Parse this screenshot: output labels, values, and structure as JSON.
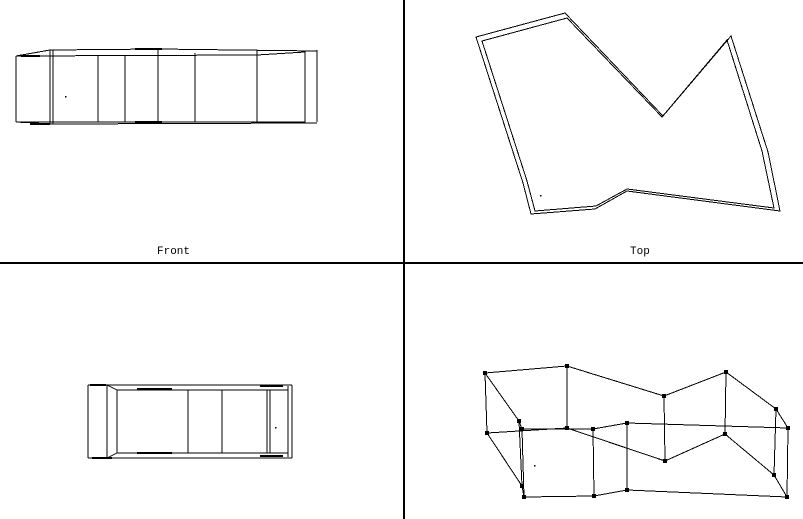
{
  "window": {
    "width": 803,
    "height": 519,
    "background": "#ffffff",
    "line_color": "#000000",
    "divider_color": "#000000"
  },
  "viewports": {
    "front": {
      "label": "Front",
      "region": [
        0,
        0,
        403,
        262
      ]
    },
    "top": {
      "label": "Top",
      "region": [
        405,
        0,
        398,
        262
      ]
    },
    "side": {
      "label": "",
      "region": [
        0,
        264,
        403,
        255
      ]
    },
    "user": {
      "label": "",
      "region": [
        405,
        264,
        398,
        255
      ]
    }
  },
  "geometry": {
    "front": {
      "segments": [
        [
          16,
          56,
          16,
          122
        ],
        [
          50,
          50,
          50,
          124
        ],
        [
          53,
          50,
          53,
          124
        ],
        [
          98,
          56,
          98,
          122
        ],
        [
          125,
          56,
          125,
          122
        ],
        [
          158,
          49,
          158,
          123
        ],
        [
          195,
          53,
          195,
          122
        ],
        [
          257,
          50,
          257,
          122
        ],
        [
          305,
          51,
          305,
          123
        ],
        [
          317,
          50,
          317,
          122
        ],
        [
          16,
          56,
          257,
          55
        ],
        [
          257,
          55,
          305,
          52
        ],
        [
          50,
          50,
          158,
          49
        ],
        [
          158,
          49,
          317,
          51
        ],
        [
          16,
          56,
          50,
          50
        ],
        [
          16,
          122,
          305,
          122
        ],
        [
          53,
          124,
          317,
          123
        ],
        [
          16,
          122,
          53,
          124
        ]
      ],
      "thick_segments": [
        [
          21,
          56,
          40,
          56
        ],
        [
          30,
          124,
          50,
          124
        ],
        [
          135,
          49,
          162,
          49
        ],
        [
          135,
          122,
          162,
          122
        ]
      ],
      "dots": [
        [
          65,
          96
        ]
      ]
    },
    "top": {
      "outer_polygon": [
        [
          476,
          37
        ],
        [
          565,
          13
        ],
        [
          663,
          116
        ],
        [
          731,
          36
        ],
        [
          768,
          152
        ],
        [
          780,
          211
        ],
        [
          627,
          191
        ],
        [
          595,
          209
        ],
        [
          531,
          214
        ],
        [
          523,
          183
        ]
      ],
      "inner_polygon": [
        [
          482,
          41
        ],
        [
          567,
          18
        ],
        [
          662,
          117
        ],
        [
          727,
          40
        ],
        [
          762,
          151
        ],
        [
          774,
          208
        ],
        [
          627,
          189
        ],
        [
          596,
          206
        ],
        [
          535,
          211
        ],
        [
          527,
          181
        ]
      ],
      "dots": [
        [
          540,
          195
        ]
      ]
    },
    "side": {
      "segments": [
        [
          88,
          385,
          88,
          458
        ],
        [
          107,
          385,
          107,
          458
        ],
        [
          117,
          390,
          117,
          453
        ],
        [
          188,
          390,
          188,
          453
        ],
        [
          222,
          390,
          222,
          453
        ],
        [
          267,
          390,
          267,
          453
        ],
        [
          270,
          390,
          270,
          453
        ],
        [
          288,
          386,
          288,
          457
        ],
        [
          292,
          385,
          292,
          458
        ],
        [
          88,
          385,
          292,
          385
        ],
        [
          117,
          390,
          288,
          390
        ],
        [
          88,
          458,
          292,
          458
        ],
        [
          117,
          453,
          288,
          453
        ],
        [
          107,
          385,
          117,
          390
        ],
        [
          107,
          458,
          117,
          453
        ]
      ],
      "thick_segments": [
        [
          90,
          385,
          106,
          385
        ],
        [
          92,
          458,
          112,
          458
        ],
        [
          137,
          389,
          172,
          389
        ],
        [
          137,
          453,
          172,
          453
        ],
        [
          260,
          386,
          283,
          386
        ],
        [
          260,
          456,
          283,
          456
        ]
      ],
      "dots": [
        [
          275,
          427
        ]
      ]
    },
    "user": {
      "top_face": [
        [
          485,
          373
        ],
        [
          567,
          366
        ],
        [
          664,
          396
        ],
        [
          726,
          372
        ],
        [
          776,
          409
        ],
        [
          788,
          428
        ],
        [
          627,
          423
        ],
        [
          593,
          429
        ],
        [
          522,
          429
        ],
        [
          519,
          421
        ]
      ],
      "bottom_face": [
        [
          487,
          433
        ],
        [
          567,
          428
        ],
        [
          665,
          461
        ],
        [
          725,
          434
        ],
        [
          774,
          475
        ],
        [
          787,
          497
        ],
        [
          627,
          490
        ],
        [
          594,
          496
        ],
        [
          524,
          497
        ],
        [
          522,
          486
        ]
      ],
      "marker_size": 4,
      "dots": [
        [
          534,
          465
        ]
      ]
    }
  }
}
